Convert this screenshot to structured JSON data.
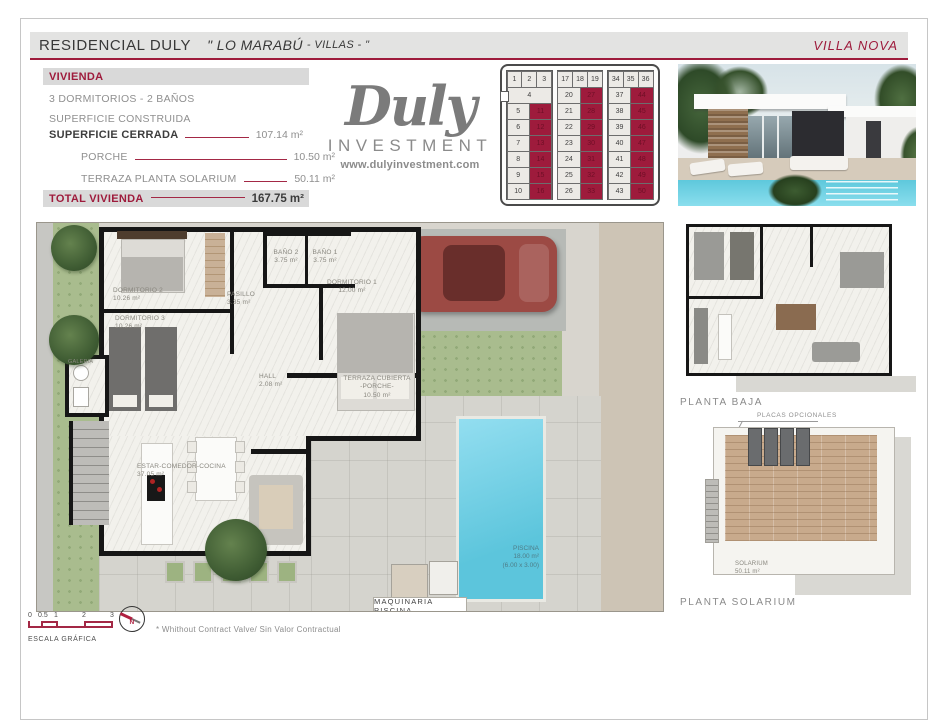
{
  "header": {
    "title": "RESIDENCIAL DULY",
    "subtitle": "\" LO MARABÚ",
    "subtitle_small": "- VILLAS - \"",
    "badge": "VILLA NOVA"
  },
  "info": {
    "section_label": "VIVIENDA",
    "line1": "3 DORMITORIOS - 2 BAÑOS",
    "line2": "SUPERFICIE CONSTRUIDA",
    "rows": [
      {
        "label": "SUPERFICIE CERRADA",
        "value": "107.14 m²"
      },
      {
        "label": "PORCHE",
        "value": "10.50 m²"
      },
      {
        "label": "TERRAZA PLANTA SOLARIUM",
        "value": "50.11 m²"
      }
    ],
    "total_label": "TOTAL VIVIENDA",
    "total_value": "167.75 m²"
  },
  "logo": {
    "script": "Duly",
    "investment": "INVESTMENT",
    "url": "www.dulyinvestment.com"
  },
  "site_grid": {
    "highlight_color": "#9e1b3c",
    "groups": [
      {
        "top": [
          "1",
          "2",
          "3"
        ],
        "special": "4",
        "rows": [
          [
            "5",
            "11"
          ],
          [
            "6",
            "12"
          ],
          [
            "7",
            "13"
          ],
          [
            "8",
            "14"
          ],
          [
            "9",
            "15"
          ],
          [
            "10",
            "16"
          ]
        ]
      },
      {
        "top": [
          "17",
          "18",
          "19"
        ],
        "rows": [
          [
            "20",
            "27"
          ],
          [
            "21",
            "28"
          ],
          [
            "22",
            "29"
          ],
          [
            "23",
            "30"
          ],
          [
            "24",
            "31"
          ],
          [
            "25",
            "32"
          ],
          [
            "26",
            "33"
          ]
        ]
      },
      {
        "top": [
          "34",
          "35",
          "36"
        ],
        "rows": [
          [
            "37",
            "44"
          ],
          [
            "38",
            "45"
          ],
          [
            "39",
            "46"
          ],
          [
            "40",
            "47"
          ],
          [
            "41",
            "48"
          ],
          [
            "42",
            "49"
          ],
          [
            "43",
            "50"
          ]
        ]
      }
    ]
  },
  "floor_plan": {
    "rooms": {
      "dormitorio2": {
        "name": "DORMITORIO 2",
        "area": "10.26 m²"
      },
      "dormitorio3": {
        "name": "DORMITORIO 3",
        "area": "10.26 m²"
      },
      "bano2": {
        "name": "BAÑO 2",
        "area": "3.75 m²"
      },
      "bano1": {
        "name": "BAÑO 1",
        "area": "3.75 m²"
      },
      "pasillo": {
        "name": "PASILLO",
        "area": "3.35 m²"
      },
      "dormitorio1": {
        "name": "DORMITORIO 1",
        "area": "12.00 m²"
      },
      "hall": {
        "name": "HALL",
        "area": "2.08 m²"
      },
      "terraza": {
        "name": "TERRAZA CUBIERTA",
        "name2": "-PORCHE-",
        "area": "10.50 m²"
      },
      "estar": {
        "name": "ESTAR-COMEDOR-COCINA",
        "area": "37.05 m²"
      },
      "galeria": {
        "name": "GALERIA"
      }
    },
    "pool": {
      "name": "PISCINA",
      "area": "18.00 m²",
      "dims": "(6.00 x 3.00)"
    },
    "maquinaria": "MAQUINARIA PISCINA"
  },
  "side_plans": {
    "planta_baja": "PLANTA BAJA",
    "placas": "PLACAS OPCIONALES",
    "planta_solarium": "PLANTA SOLARIUM",
    "solarium": {
      "name": "SOLARIUM",
      "area": "50.11 m²"
    }
  },
  "footer": {
    "ticks": [
      "0",
      "0.5",
      "1",
      "2",
      "3"
    ],
    "scale_label": "ESCALA GRÁFICA",
    "north": "N",
    "disclaimer": "* Whithout Contract Valve/ Sin Valor Contractual"
  },
  "colors": {
    "accent": "#9e1b3c",
    "logo_gray": "#7b7b7b",
    "pool_cyan": "#5cc5dc"
  }
}
